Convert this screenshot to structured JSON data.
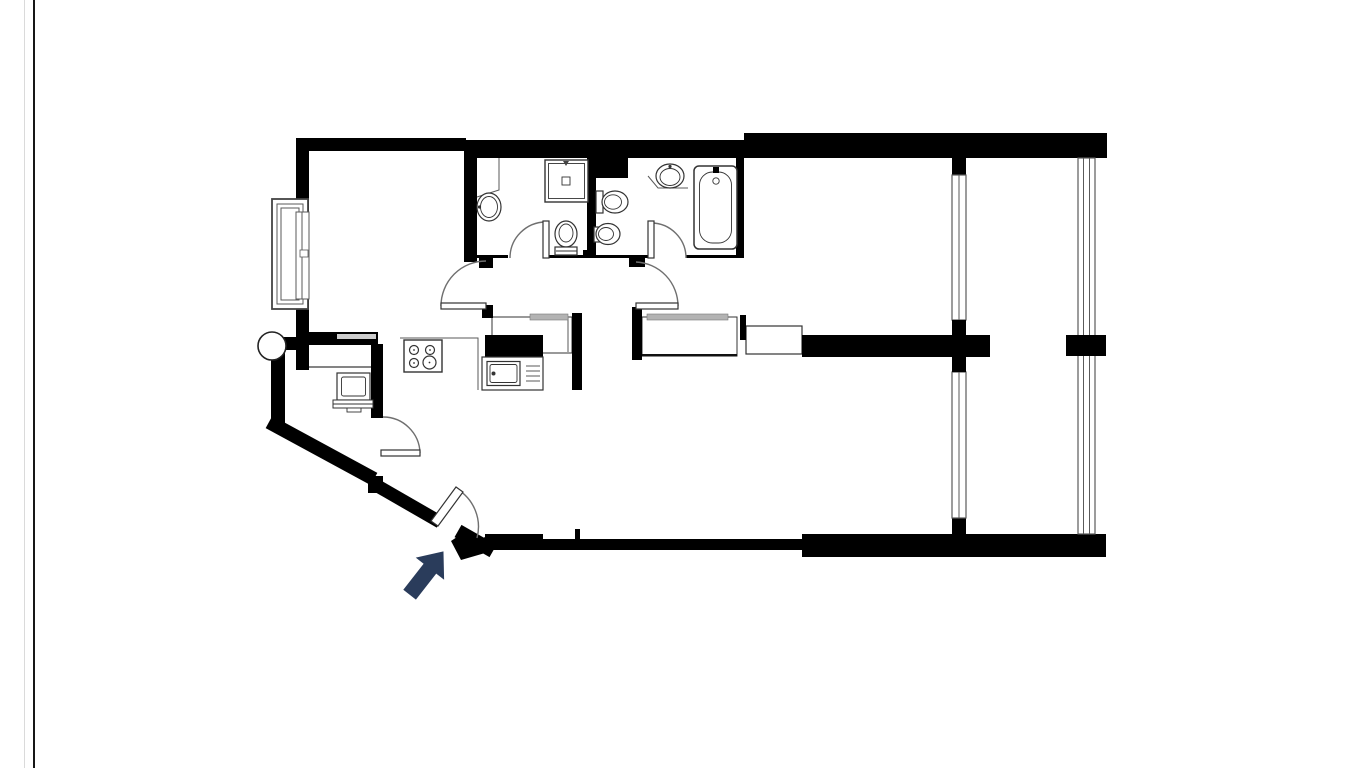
{
  "page": {
    "kind": "apartment-floor-plan-drawing",
    "background": "#ffffff"
  },
  "colors": {
    "background": "#ffffff",
    "wall": "#000000",
    "fixture_line": "#333333",
    "detail_line": "#5a5a5a",
    "door_arc": "#6f6f6f",
    "shelf": "#b3b3b3",
    "wall_stripe": "#cdcdcd",
    "arrow": "#2a3c5b",
    "edge_dark": "#161616",
    "edge_light": "#dadada"
  },
  "icons": {
    "entrance_arrow": "entrance-direction-arrow",
    "fixtures": [
      "left-window",
      "round-column",
      "shower-tray",
      "washbasin",
      "toilet",
      "bidet",
      "bathtub",
      "stove-burners",
      "kitchen-sink",
      "tv-stand",
      "hall-wardrobe",
      "bedroom-wardrobe",
      "dresser",
      "glazed-partition",
      "right-window",
      "entrance-door",
      "interior-door"
    ]
  }
}
